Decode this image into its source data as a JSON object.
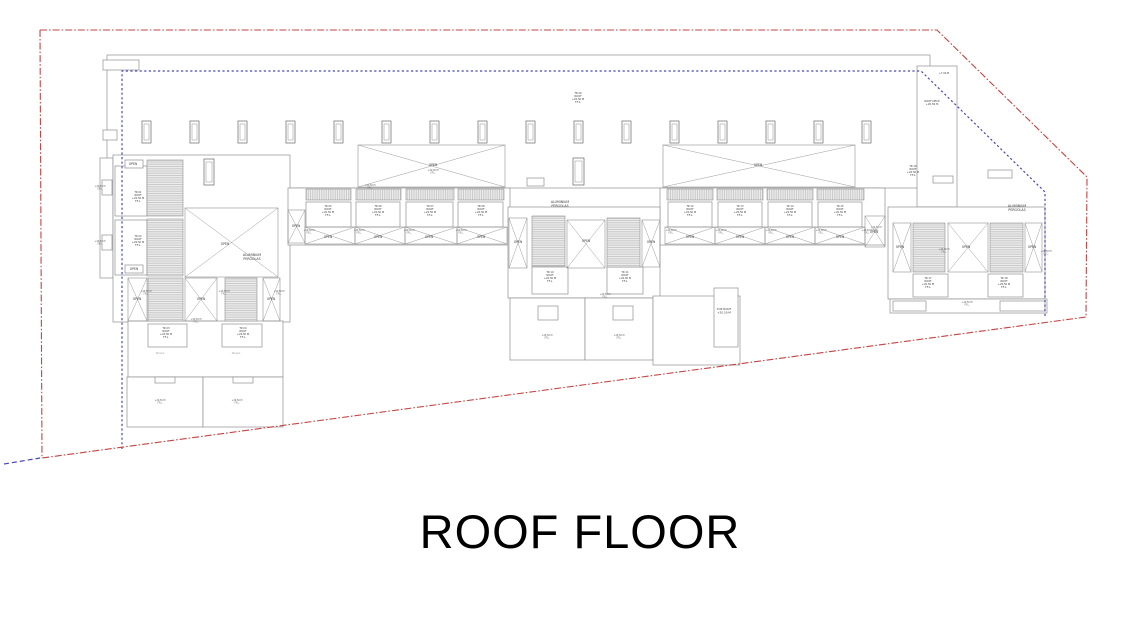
{
  "title": "ROOF FLOOR",
  "labels": {
    "open": "OPEN",
    "roof": "ROOF",
    "level": "+20.50 M",
    "ffl": "F.F.L.",
    "pergolas": "ALUMINIUM PERGOLAS",
    "top_roof": "TOP ROOF",
    "roof_deck": "ROOF DECK",
    "terrace": "Terrace",
    "tos": "+7.00 M"
  },
  "colors": {
    "boundary": "#c64444",
    "setback": "#4747b8",
    "line": "#8f8f8f",
    "line_dark": "#666666",
    "text": "#3a3a3a",
    "faint": "#9a9a9a"
  },
  "plan": {
    "boundary_points": "40,30 937,30 1087,177 1086,317 42,458 40,30",
    "setback_points": "122,449 122,71 921,71 1045,192 1045,316",
    "setback_stub": "4,464 40,458",
    "blocks": [
      [
        107,
        55,
        823,
        133
      ],
      [
        103,
        60,
        36,
        10
      ],
      [
        103,
        130,
        14,
        10
      ],
      [
        100,
        158,
        13,
        120
      ],
      [
        102,
        180,
        10,
        15
      ],
      [
        102,
        235,
        10,
        15
      ],
      [
        113,
        155,
        177,
        167
      ],
      [
        115,
        166,
        32,
        50
      ],
      [
        115,
        220,
        32,
        55
      ],
      [
        125,
        160,
        18,
        8
      ],
      [
        125,
        265,
        18,
        8
      ],
      [
        128,
        321,
        155,
        56
      ],
      [
        148,
        324,
        39,
        23
      ],
      [
        222,
        324,
        40,
        23
      ],
      [
        127,
        377,
        76,
        50
      ],
      [
        203,
        377,
        80,
        50
      ],
      [
        155,
        377,
        20,
        6
      ],
      [
        233,
        377,
        20,
        6
      ],
      [
        288,
        188,
        222,
        57
      ],
      [
        306,
        202,
        45,
        25
      ],
      [
        356,
        202,
        44,
        25
      ],
      [
        406,
        202,
        47,
        25
      ],
      [
        458,
        202,
        45,
        25
      ],
      [
        660,
        188,
        225,
        57
      ],
      [
        668,
        202,
        44,
        25
      ],
      [
        718,
        202,
        44,
        25
      ],
      [
        768,
        202,
        44,
        25
      ],
      [
        818,
        202,
        44,
        25
      ],
      [
        508,
        207,
        152,
        91
      ],
      [
        532,
        267,
        36,
        27
      ],
      [
        607,
        267,
        36,
        27
      ],
      [
        510,
        298,
        75,
        62
      ],
      [
        585,
        298,
        68,
        62
      ],
      [
        538,
        306,
        20,
        14
      ],
      [
        613,
        306,
        20,
        14
      ],
      [
        653,
        296,
        87,
        69
      ],
      [
        714,
        288,
        24,
        59
      ],
      [
        917,
        66,
        40,
        141
      ],
      [
        933,
        176,
        20,
        7
      ],
      [
        988,
        170,
        24,
        8
      ],
      [
        527,
        178,
        17,
        8
      ],
      [
        888,
        207,
        157,
        92
      ],
      [
        913,
        274,
        35,
        23
      ],
      [
        988,
        274,
        35,
        23
      ],
      [
        890,
        299,
        157,
        14
      ],
      [
        893,
        301,
        33,
        10
      ],
      [
        1000,
        301,
        45,
        10
      ]
    ],
    "hatch_h": [
      [
        147,
        160,
        36,
        56
      ],
      [
        147,
        219,
        36,
        57
      ],
      [
        148,
        278,
        35,
        43
      ],
      [
        225,
        278,
        32,
        43
      ],
      [
        532,
        216,
        33,
        50
      ],
      [
        607,
        218,
        33,
        49
      ],
      [
        913,
        223,
        32,
        49
      ],
      [
        990,
        223,
        33,
        49
      ]
    ],
    "hatch_v": [
      [
        306,
        189,
        45,
        11
      ],
      [
        356,
        189,
        45,
        11
      ],
      [
        406,
        189,
        48,
        11
      ],
      [
        458,
        189,
        46,
        11
      ],
      [
        667,
        189,
        46,
        11
      ],
      [
        717,
        189,
        46,
        11
      ],
      [
        767,
        189,
        46,
        11
      ],
      [
        817,
        189,
        47,
        11
      ]
    ],
    "cross_rects": [
      [
        185,
        208,
        93,
        69
      ],
      [
        358,
        145,
        147,
        42
      ],
      [
        663,
        145,
        192,
        42
      ],
      [
        305,
        227,
        50,
        17
      ],
      [
        355,
        227,
        50,
        17
      ],
      [
        405,
        227,
        52,
        17
      ],
      [
        457,
        227,
        50,
        17
      ],
      [
        665,
        227,
        50,
        17
      ],
      [
        715,
        227,
        50,
        17
      ],
      [
        765,
        227,
        50,
        17
      ],
      [
        815,
        227,
        50,
        17
      ],
      [
        185,
        278,
        32,
        43
      ],
      [
        128,
        278,
        19,
        43
      ],
      [
        263,
        278,
        17,
        43
      ],
      [
        567,
        220,
        38,
        48
      ],
      [
        509,
        218,
        18,
        50
      ],
      [
        642,
        220,
        18,
        47
      ],
      [
        948,
        223,
        40,
        49
      ],
      [
        893,
        223,
        18,
        49
      ],
      [
        1025,
        223,
        17,
        49
      ],
      [
        288,
        210,
        17,
        33
      ],
      [
        865,
        216,
        20,
        31
      ]
    ],
    "vents": [
      [
        142,
        121,
        9,
        22
      ],
      [
        190,
        121,
        9,
        22
      ],
      [
        238,
        121,
        9,
        22
      ],
      [
        286,
        121,
        9,
        22
      ],
      [
        334,
        121,
        9,
        22
      ],
      [
        382,
        121,
        9,
        22
      ],
      [
        430,
        121,
        9,
        22
      ],
      [
        478,
        121,
        9,
        22
      ],
      [
        526,
        121,
        9,
        22
      ],
      [
        574,
        121,
        9,
        22
      ],
      [
        622,
        121,
        9,
        22
      ],
      [
        670,
        121,
        9,
        22
      ],
      [
        718,
        121,
        9,
        22
      ],
      [
        766,
        121,
        9,
        22
      ],
      [
        814,
        121,
        9,
        22
      ],
      [
        862,
        121,
        9,
        22
      ],
      [
        204,
        159,
        10,
        26
      ],
      [
        573,
        158,
        11,
        27
      ]
    ],
    "open_labels": [
      [
        133,
        165
      ],
      [
        134,
        270
      ],
      [
        225,
        245
      ],
      [
        433,
        166
      ],
      [
        758,
        166
      ],
      [
        328,
        238
      ],
      [
        378,
        238
      ],
      [
        429,
        238
      ],
      [
        481,
        238
      ],
      [
        690,
        238
      ],
      [
        740,
        238
      ],
      [
        790,
        238
      ],
      [
        840,
        238
      ],
      [
        137,
        300
      ],
      [
        201,
        300
      ],
      [
        271,
        300
      ],
      [
        518,
        243
      ],
      [
        586,
        242
      ],
      [
        651,
        243
      ],
      [
        900,
        248
      ],
      [
        966,
        248
      ],
      [
        1032,
        248
      ],
      [
        296,
        227
      ],
      [
        874,
        233
      ]
    ],
    "room_labels": [
      {
        "tr": "TR 01",
        "x": 138,
        "y": 193
      },
      {
        "tr": "TR 02",
        "x": 138,
        "y": 237
      },
      {
        "tr": "TR 03",
        "x": 166,
        "y": 329
      },
      {
        "tr": "TR 04",
        "x": 243,
        "y": 329
      },
      {
        "tr": "TR 05",
        "x": 328,
        "y": 207
      },
      {
        "tr": "TR 06",
        "x": 378,
        "y": 207
      },
      {
        "tr": "TR 07",
        "x": 430,
        "y": 207
      },
      {
        "tr": "TR 08",
        "x": 481,
        "y": 207
      },
      {
        "tr": "TR 09",
        "x": 578,
        "y": 94
      },
      {
        "tr": "TR 10",
        "x": 550,
        "y": 273
      },
      {
        "tr": "TR 11",
        "x": 625,
        "y": 273
      },
      {
        "tr": "TR 12",
        "x": 690,
        "y": 207
      },
      {
        "tr": "TR 13",
        "x": 740,
        "y": 207
      },
      {
        "tr": "TR 14",
        "x": 790,
        "y": 207
      },
      {
        "tr": "TR 15",
        "x": 840,
        "y": 207
      },
      {
        "tr": "TR 16",
        "x": 913,
        "y": 167
      },
      {
        "tr": "TR 17",
        "x": 928,
        "y": 279
      },
      {
        "tr": "TR 18",
        "x": 1004,
        "y": 279
      }
    ],
    "level_markers": [
      [
        100,
        187
      ],
      [
        100,
        242
      ],
      [
        146,
        292
      ],
      [
        224,
        292
      ],
      [
        279,
        292
      ],
      [
        196,
        320
      ],
      [
        309,
        231
      ],
      [
        359,
        231
      ],
      [
        409,
        231
      ],
      [
        461,
        231
      ],
      [
        370,
        186
      ],
      [
        433,
        171
      ],
      [
        160,
        401
      ],
      [
        237,
        401
      ],
      [
        547,
        336
      ],
      [
        619,
        336
      ],
      [
        605,
        295
      ],
      [
        671,
        231
      ],
      [
        721,
        231
      ],
      [
        771,
        231
      ],
      [
        821,
        231
      ],
      [
        867,
        231
      ],
      [
        876,
        228
      ],
      [
        944,
        250
      ],
      [
        1046,
        252
      ],
      [
        967,
        303
      ]
    ],
    "text_labels": [
      {
        "x": 252,
        "y": 256,
        "key": "pergolas",
        "wrap": true,
        "size": 3.2
      },
      {
        "x": 560,
        "y": 203,
        "key": "pergolas",
        "wrap": true,
        "size": 3.2
      },
      {
        "x": 1017,
        "y": 207,
        "key": "pergolas",
        "wrap": true,
        "size": 3.2
      },
      {
        "x": 724,
        "y": 310,
        "key": "top_roof",
        "level": true,
        "size": 2.8
      },
      {
        "x": 932,
        "y": 102,
        "key": "roof_deck",
        "level": true,
        "size": 2.6
      },
      {
        "x": 944,
        "y": 74,
        "key": "tos",
        "size": 2.4
      },
      {
        "x": 160,
        "y": 354,
        "key": "terrace",
        "size": 2.4,
        "faint": true
      },
      {
        "x": 236,
        "y": 354,
        "key": "terrace",
        "size": 2.4,
        "faint": true
      }
    ]
  }
}
